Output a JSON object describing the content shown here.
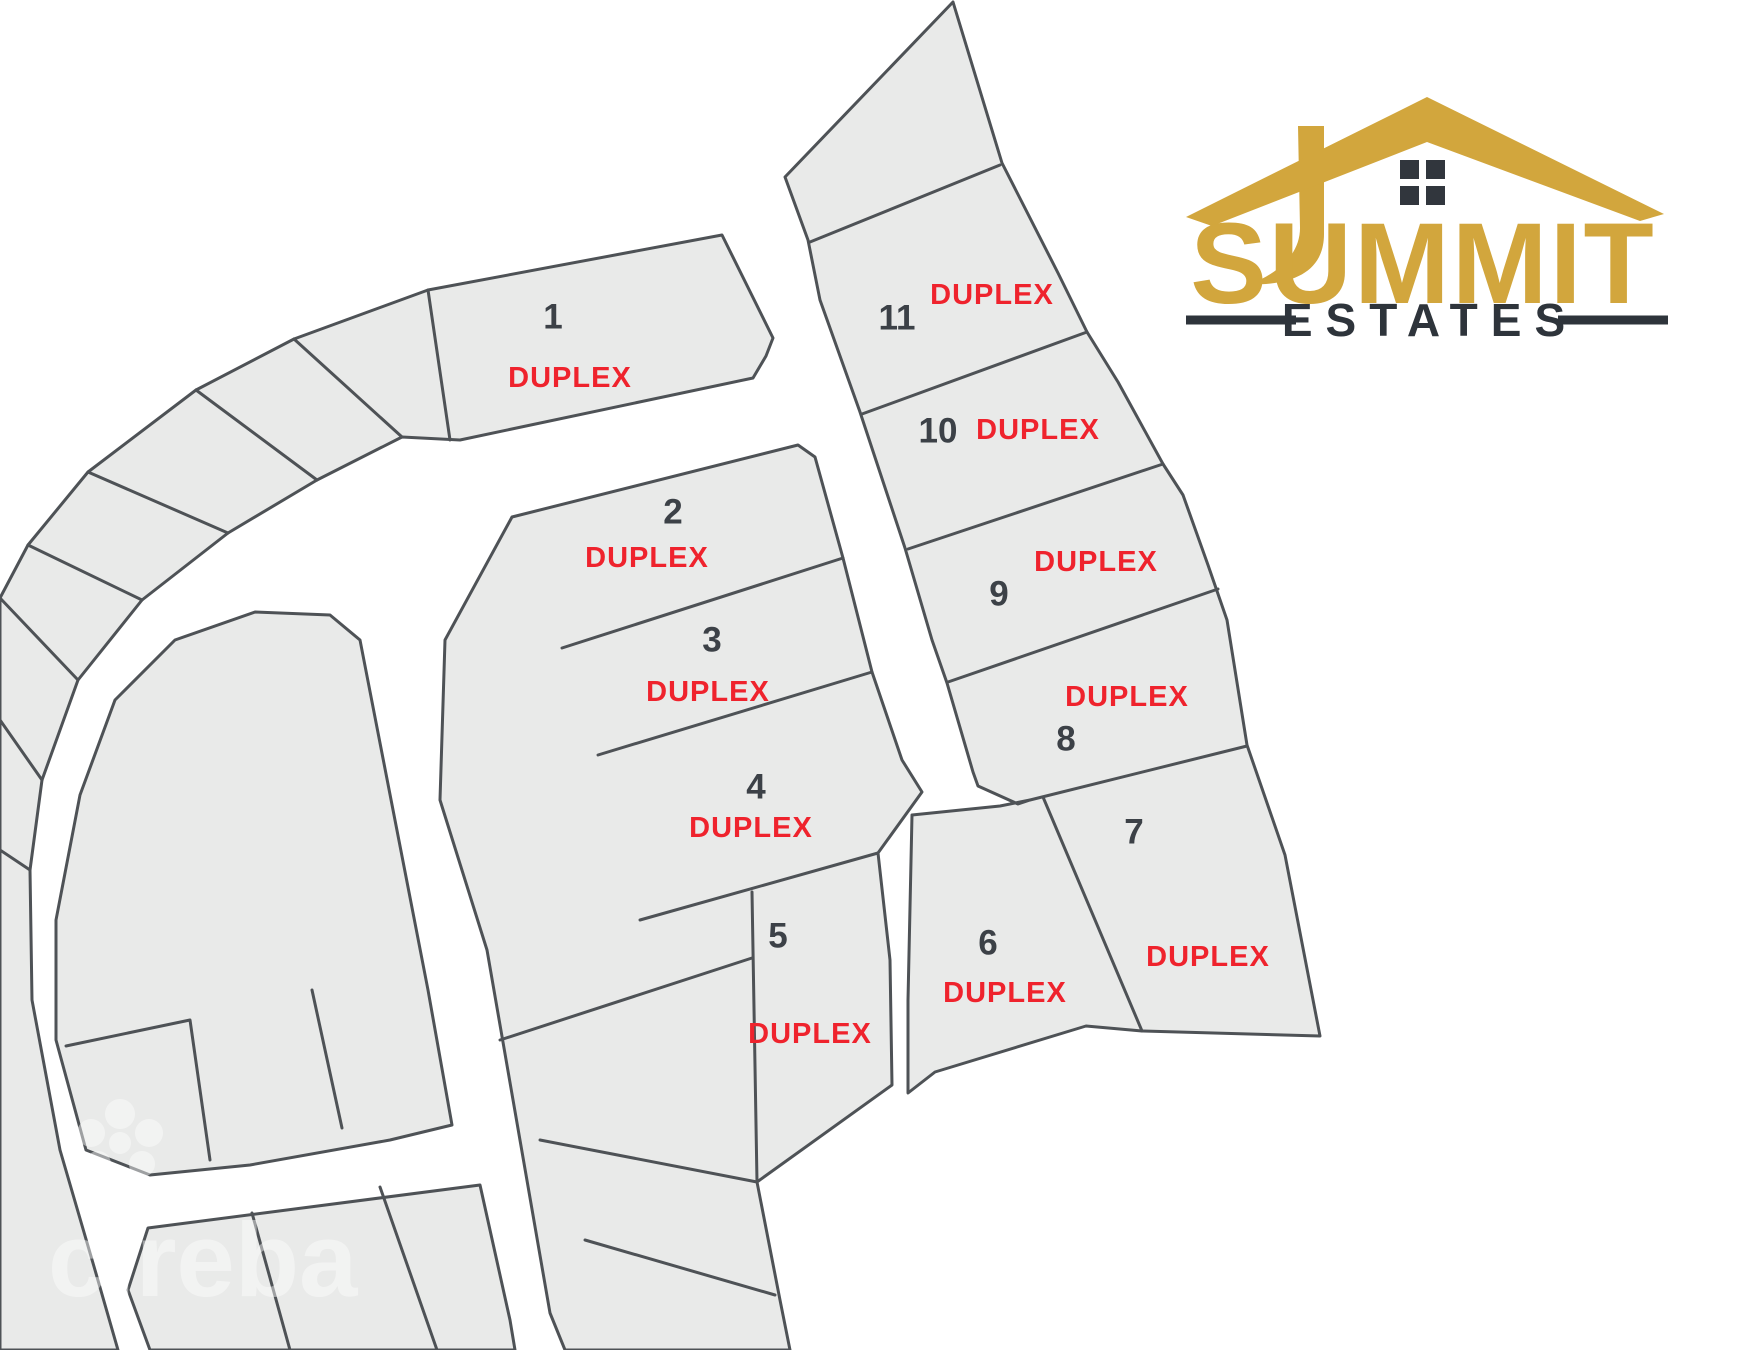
{
  "logo": {
    "title": "SUMMIT",
    "subtitle": "ESTATES",
    "gold_color": "#D2A63D",
    "dark_color": "#2E343B"
  },
  "watermark": {
    "text": "cireba"
  },
  "map": {
    "lot_fill": "#E9EAE9",
    "lot_stroke": "#4E5256",
    "number_color": "#3C4147",
    "duplex_color": "#EF232D",
    "lots": [
      {
        "number": "1",
        "label": "DUPLEX",
        "number_pos": [
          553,
          317
        ],
        "label_pos": [
          570,
          378
        ]
      },
      {
        "number": "2",
        "label": "DUPLEX",
        "number_pos": [
          673,
          512
        ],
        "label_pos": [
          647,
          558
        ]
      },
      {
        "number": "3",
        "label": "DUPLEX",
        "number_pos": [
          712,
          640
        ],
        "label_pos": [
          708,
          692
        ]
      },
      {
        "number": "4",
        "label": "DUPLEX",
        "number_pos": [
          756,
          787
        ],
        "label_pos": [
          751,
          828
        ]
      },
      {
        "number": "5",
        "label": "DUPLEX",
        "number_pos": [
          778,
          936
        ],
        "label_pos": [
          810,
          1034
        ]
      },
      {
        "number": "6",
        "label": "DUPLEX",
        "number_pos": [
          988,
          943
        ],
        "label_pos": [
          1005,
          993
        ]
      },
      {
        "number": "7",
        "label": "DUPLEX",
        "number_pos": [
          1134,
          832
        ],
        "label_pos": [
          1208,
          957
        ]
      },
      {
        "number": "8",
        "label": "DUPLEX",
        "number_pos": [
          1066,
          739
        ],
        "label_pos": [
          1127,
          697
        ]
      },
      {
        "number": "9",
        "label": "DUPLEX",
        "number_pos": [
          999,
          594
        ],
        "label_pos": [
          1096,
          562
        ]
      },
      {
        "number": "10",
        "label": "DUPLEX",
        "number_pos": [
          938,
          431
        ],
        "label_pos": [
          1038,
          430
        ]
      },
      {
        "number": "11",
        "label": "DUPLEX",
        "number_pos": [
          897,
          318
        ],
        "label_pos": [
          992,
          295
        ]
      }
    ]
  }
}
